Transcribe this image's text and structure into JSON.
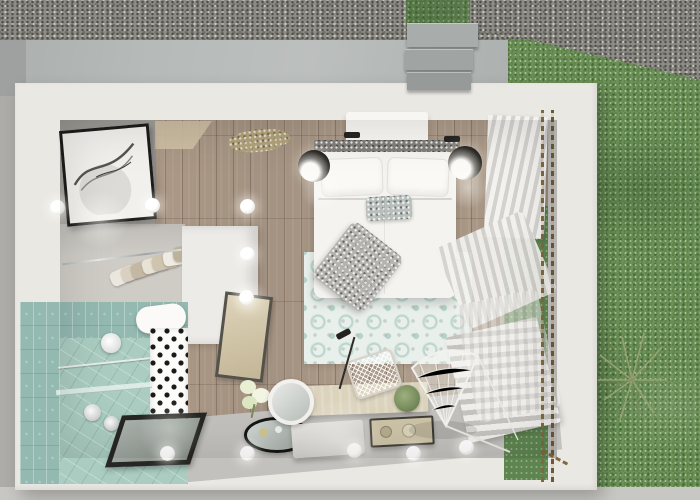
{
  "meta": {
    "title": "Top-down 3D render of a studio hotel room with bathroom, wardrobe and garden",
    "type": "architectural-render",
    "view": "bird's-eye"
  },
  "palette": {
    "grass": "#6b9156",
    "grass_window": "#5e8450",
    "gravel": "#8d8b85",
    "concrete": "#b6bab8",
    "path_edge": "#9b9f9d",
    "outer_wall_white": "#eae8e3",
    "interior_wall_gray": "#a9a6a1",
    "interior_floor_gray": "#c5c3bf",
    "wood_floor": "#b3a190",
    "soffit_beige": "#cdbfa4",
    "tile_teal_wall": "#93b9b1",
    "tile_teal_floor": "#aaccc1",
    "rug_base": "#e9efeb",
    "rug_pattern_teal": "#7db4a8",
    "bed_white": "#f4f3ef",
    "headboard_gray": "#827e79",
    "blanket_gray": "#b5b3af",
    "curtain_white": "#f3f2ef",
    "bead_brown": "#82683f",
    "desk_wood": "#dcd3bd",
    "tray_black_rim": "#151513",
    "drain_frame": "#262624",
    "partition_white": "#edebe7",
    "mirror_frame": "#55524b",
    "mirror_face_tan": "#d4c8ab"
  },
  "scene": {
    "outdoor": [
      "gravel-border",
      "concrete-path",
      "garden-steps",
      "lawn",
      "dried-grass-plant"
    ],
    "rooms": [
      "bedroom",
      "bathroom",
      "wardrobe-closet"
    ],
    "objects": [
      "double-bed",
      "pillows",
      "decor-cushion",
      "throw-blanket",
      "headboard",
      "ac-unit",
      "wall-lamps",
      "wall-art",
      "patterned-rug",
      "pendant-sphere-lights",
      "desk",
      "desk-chair",
      "desk-lamp",
      "round-mirror",
      "flower-vase",
      "oval-tray",
      "floor-platform",
      "serving-tray",
      "hanging-chair",
      "radiator",
      "curtains",
      "bead-strings",
      "toilet",
      "shower-drain",
      "shower-head",
      "glass-shelf",
      "polka-dot-wall",
      "clothes-rail",
      "leaning-mirror",
      "ceiling-dried-flower"
    ]
  },
  "lights": {
    "ceiling_spheres": [
      {
        "x": 50,
        "y": 200
      },
      {
        "x": 145,
        "y": 198
      },
      {
        "x": 240,
        "y": 199
      },
      {
        "x": 240,
        "y": 247
      },
      {
        "x": 239,
        "y": 290
      },
      {
        "x": 160,
        "y": 446
      },
      {
        "x": 240,
        "y": 446
      },
      {
        "x": 347,
        "y": 443
      },
      {
        "x": 406,
        "y": 446
      },
      {
        "x": 459,
        "y": 440
      }
    ]
  },
  "closet": {
    "clothes_colors": [
      "#ece7de",
      "#d9d0c0",
      "#c4b8a4",
      "#e8e2d4",
      "#cfc4ae",
      "#efebe2",
      "#bdb29c"
    ]
  }
}
